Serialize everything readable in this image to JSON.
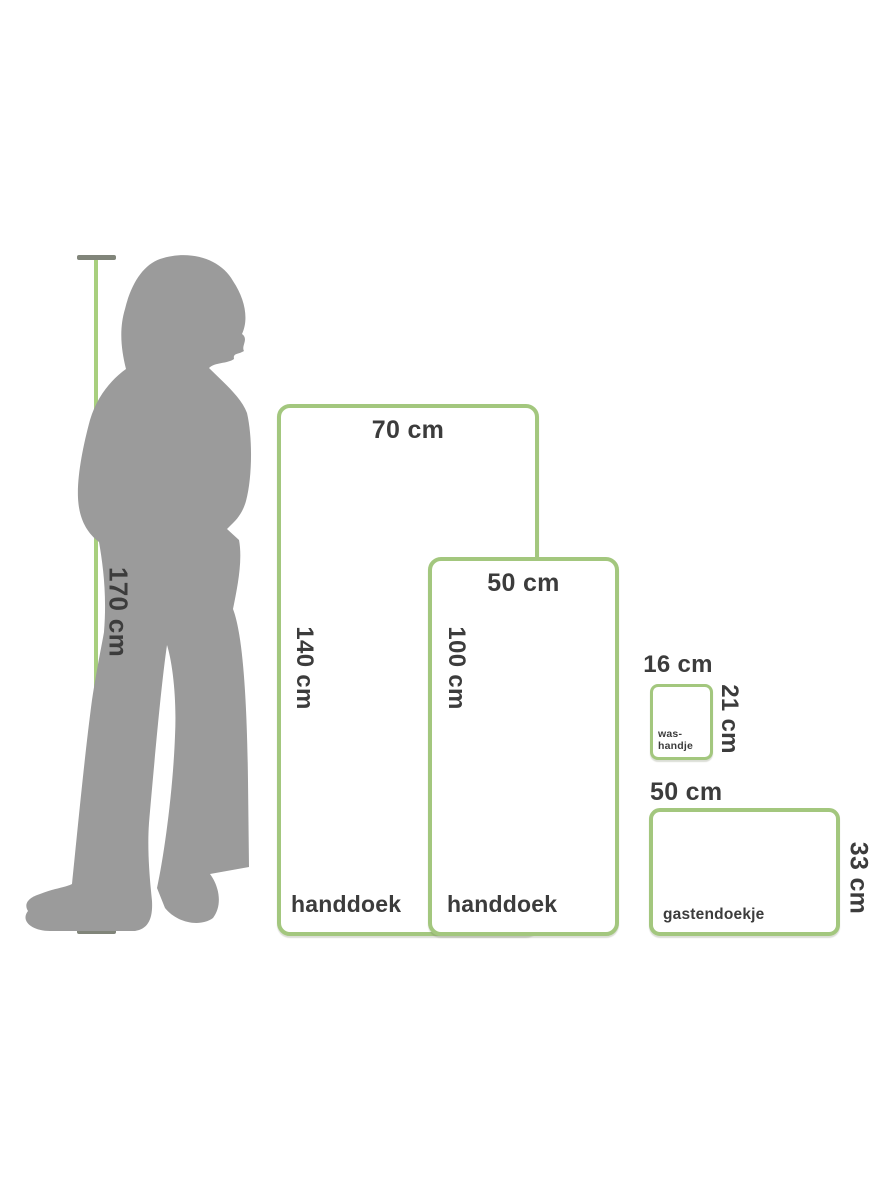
{
  "figure": {
    "type": "towel-size-comparison-diagram",
    "colors": {
      "accent_green": "#a3c77e",
      "measure_line_green": "#a8cf7e",
      "cap_gray": "#81857a",
      "silhouette_gray": "#9b9b9b",
      "text": "#3c3c3c",
      "background": "#ffffff"
    },
    "person": {
      "height_label": "170 cm"
    },
    "items": [
      {
        "name": "handdoek",
        "width_label": "70 cm",
        "height_label": "140 cm"
      },
      {
        "name": "handdoek",
        "width_label": "50 cm",
        "height_label": "100 cm"
      },
      {
        "name": "was-handje",
        "name_line1": "was-",
        "name_line2": "handje",
        "width_label": "16 cm",
        "height_label": "21 cm"
      },
      {
        "name": "gastendoekje",
        "width_label": "50 cm",
        "height_label": "33 cm"
      }
    ]
  }
}
